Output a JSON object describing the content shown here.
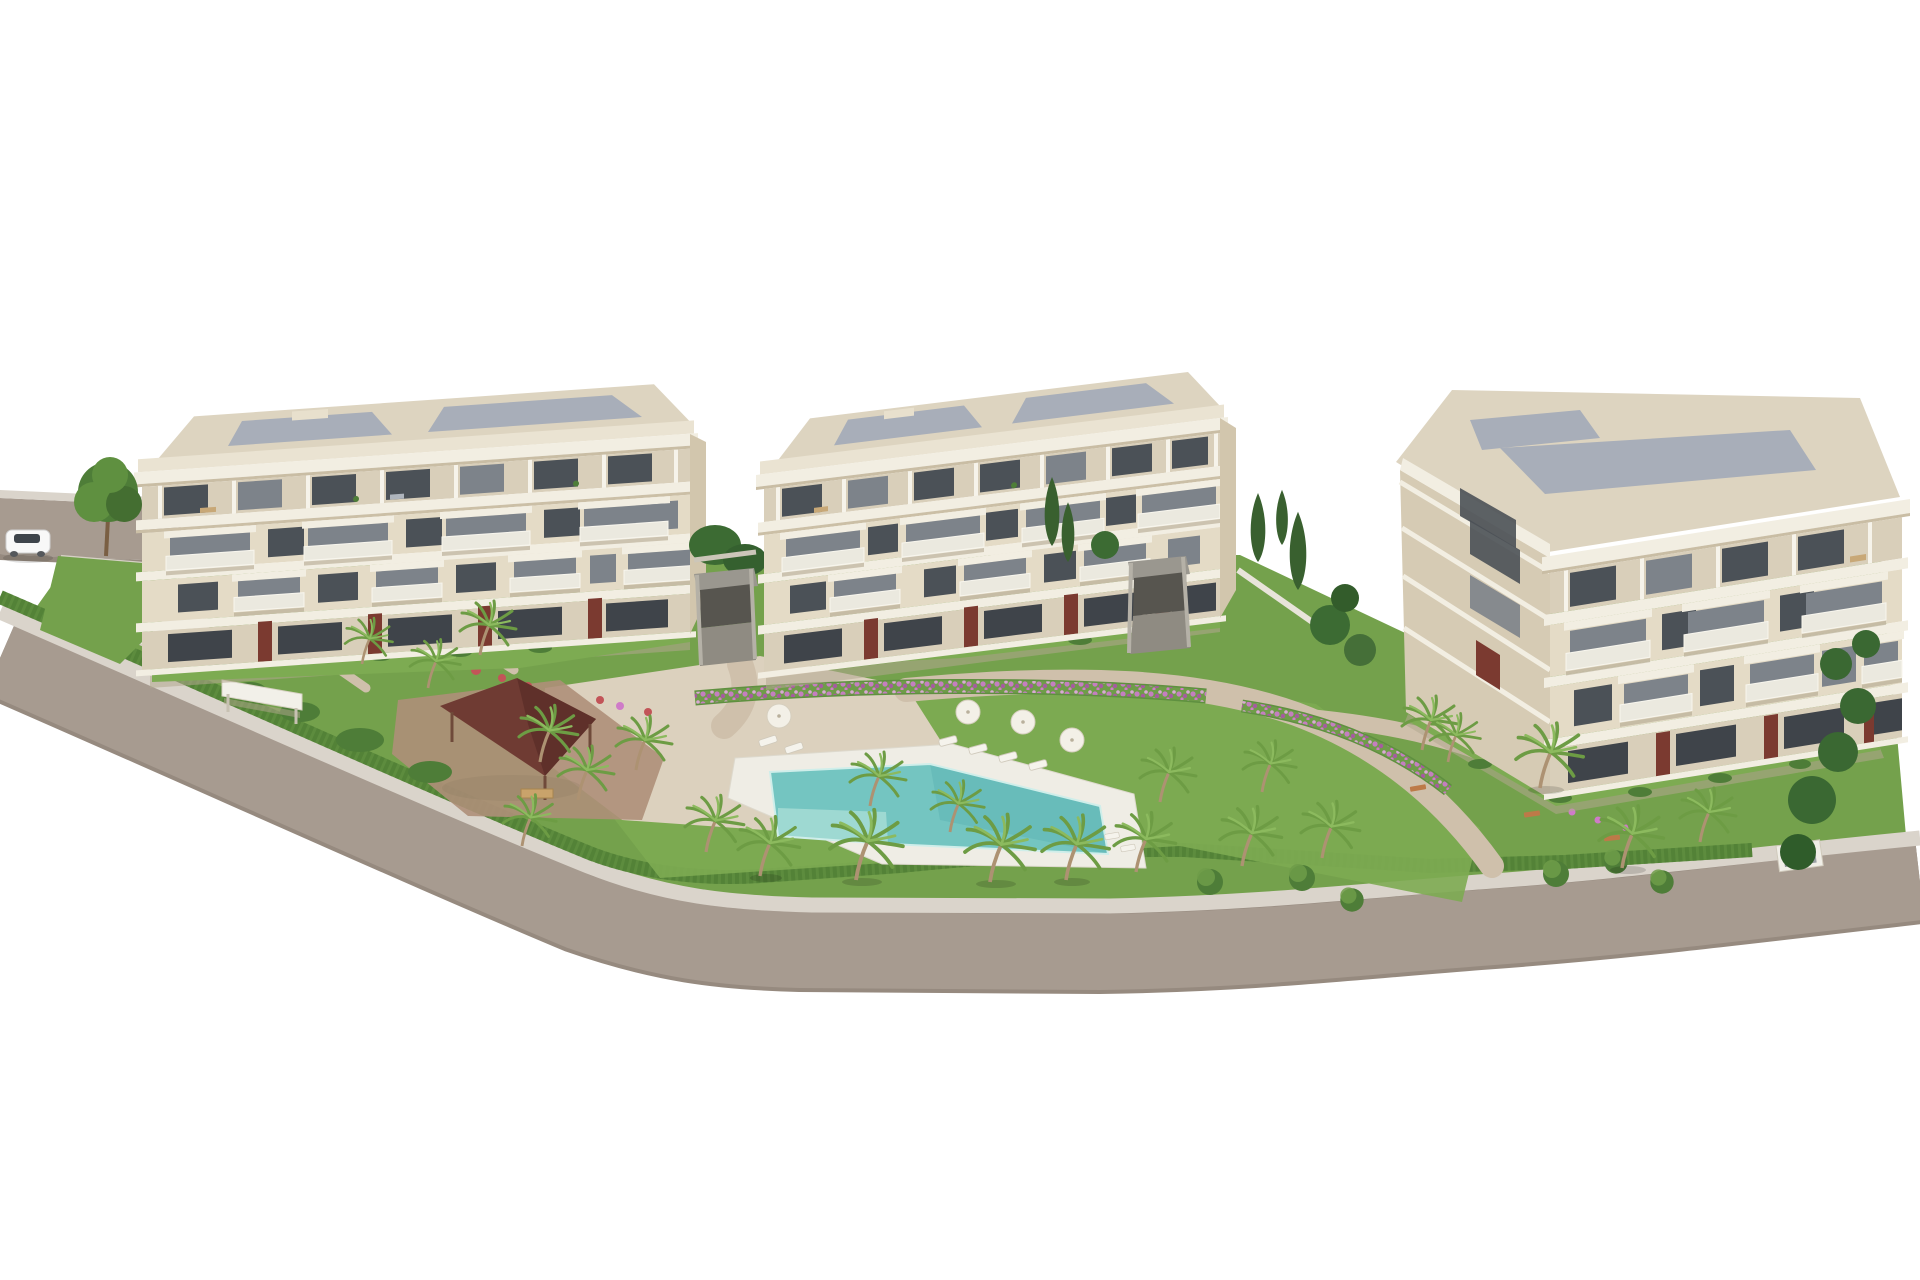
{
  "scene": {
    "type": "3D architectural rendering",
    "view": "aerial three-quarter view, white background",
    "title": "New-build residential complex — aerial 3D render",
    "subject": "Aerial 3D architectural rendering of a modern residential complex: three cream four-storey apartment buildings with glass balconies and dark-red accent panels, landscaped gardens with palm trees, a turquoise swimming pool with white deck, a dark-red roofed gazebo, sun loungers and parasols on a lawn, perimeter hedges and a curved gray road with one white car"
  },
  "palette": {
    "road": "#a79b90",
    "road-edge": "#968a7f",
    "walk": "#dad4cb",
    "lawn": "#74a14c",
    "lawn-bright": "#7dab52",
    "hedge": "#5d8c3e",
    "hedge-dark": "#4d7c33",
    "bush": "#4e7d38",
    "cypress": "#39602f",
    "palm-a": "#6d9c44",
    "palm-b": "#8cba5e",
    "trunk": "#ad9272",
    "pool": "#74c5c1",
    "pool-steps": "#a3dad4",
    "deck": "#efede5",
    "path": "#cfc0ab",
    "plaza": "#dcd1be",
    "terra": "#ae8f79",
    "gazebo": "#6f3b33",
    "gazebo-dark": "#5b2e28",
    "slab": "#f2eee2",
    "wall": "#e4dbc6",
    "wall2": "#d9cfba",
    "pier": "#cdc2aa",
    "glass": "#4b5157",
    "glass2": "#7d838a",
    "balc": "#ebe9df",
    "shad": "#b3a78f",
    "maroon": "#7b3a30",
    "roof-deck": "#ddd4c0",
    "roof-panel": "#a8aeb9",
    "wall-white": "#f0eee7",
    "car-body": "#f8f8f8",
    "car-glass": "#3e444b"
  },
  "objects": {
    "buildings": [
      {
        "id": "building-left",
        "floors": 4,
        "style": "cream facade, flat roof with gray panels, recessed penthouse terraces, protruding white balconies, dark-red ground-floor accent panels"
      },
      {
        "id": "building-middle",
        "floors": 4,
        "style": "same design as left building"
      },
      {
        "id": "building-right",
        "floors": 4,
        "style": "same design, rotated showing left end wall and front facade"
      }
    ],
    "amenities": {
      "swimming_pool": 1,
      "pool_color": "#74c5c1",
      "gazebo": 1,
      "gazebo_roof_color": "#6f3b33",
      "parasols": 4,
      "sun_loungers": 8,
      "benches": 3,
      "palm_trees": 24,
      "round_trees": 6,
      "cypress_trees": 5,
      "entrance_gates": 2,
      "garage_ramps": 3,
      "car": 1,
      "car_color": "white",
      "perimeter_road": "curved two-edge gray road with light sidewalk and continuous hedge"
    }
  }
}
